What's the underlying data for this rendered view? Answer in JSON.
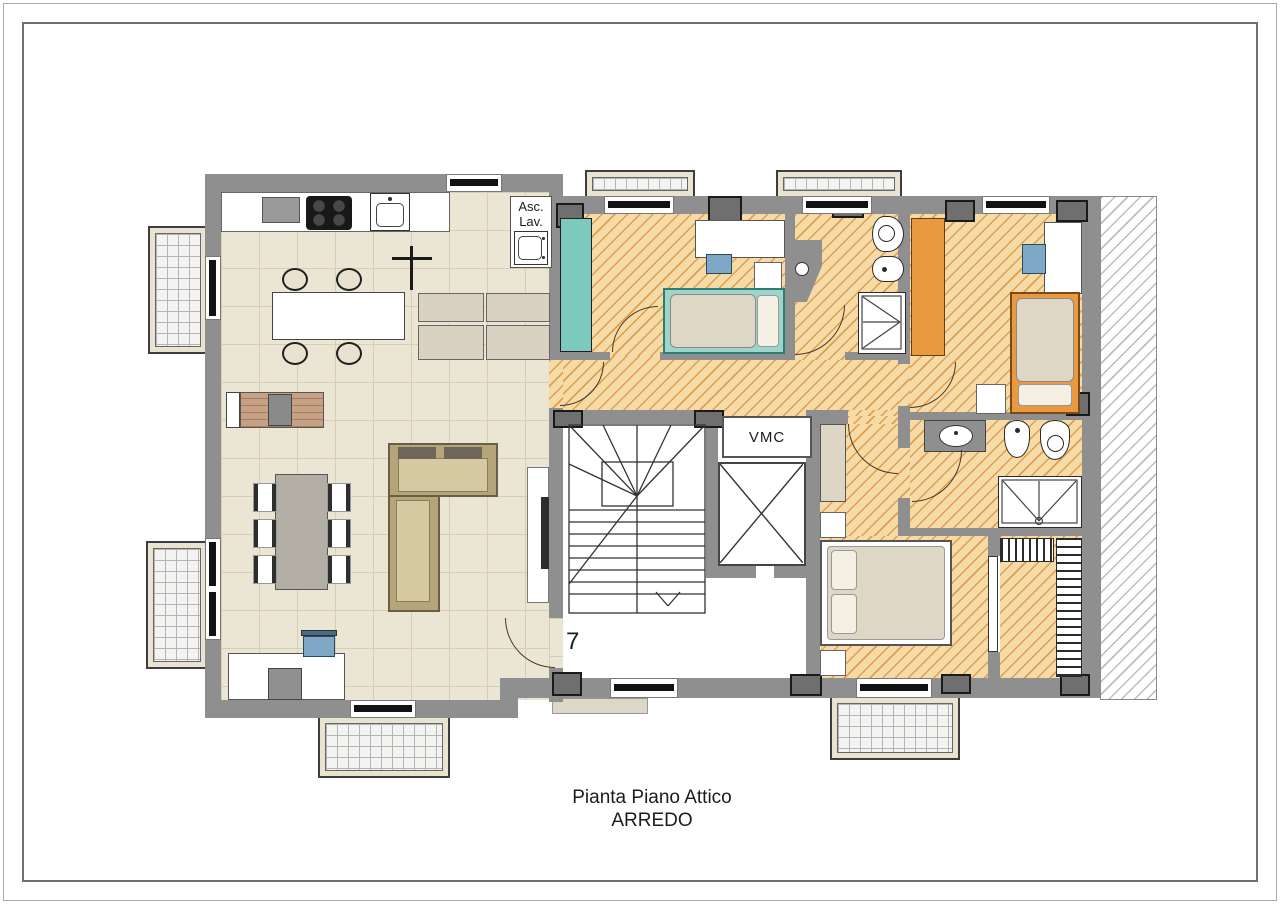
{
  "plan_labels": {
    "utility_closet_line1": "Asc.",
    "utility_closet_line2": "Lav.",
    "vmc": "VMC",
    "apartment_number": "7"
  },
  "title": {
    "line1": "Pianta Piano Attico",
    "line2": "ARREDO"
  },
  "colors": {
    "wall": "#8f8f8f",
    "pier": "#6f6f6f",
    "tile_floor": "#ebe6d4",
    "tile_line": "#d6cdb3",
    "hatch_floor": "#f7dba6",
    "hatch_line": "#dc9f52",
    "teal": "#7cc9c0",
    "orange": "#e9993f",
    "blue_chair": "#7fa8c6",
    "wood": "#c8a184",
    "sofa_frame": "#b4a67a",
    "sofa_cushion": "#d5c9a2",
    "mattress": "#ded7c5",
    "balcony_line": "#b5b5b5",
    "title_color": "#1c1c1c"
  }
}
